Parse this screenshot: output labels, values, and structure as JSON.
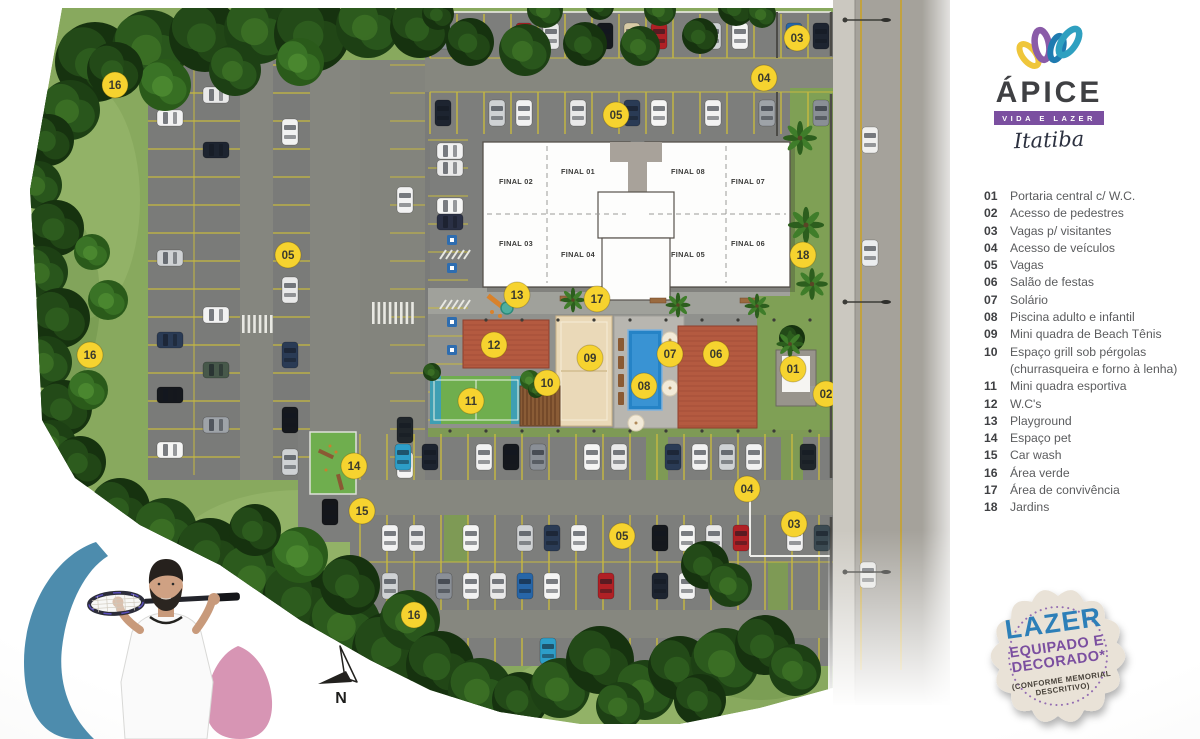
{
  "logo": {
    "name": "ÁPICE",
    "tagline": "VIDA E LAZER",
    "city": "Itatiba"
  },
  "legend": {
    "items": [
      {
        "num": "01",
        "label": "Portaria central c/ W.C."
      },
      {
        "num": "02",
        "label": "Acesso de pedestres"
      },
      {
        "num": "03",
        "label": "Vagas p/ visitantes"
      },
      {
        "num": "04",
        "label": "Acesso de veículos"
      },
      {
        "num": "05",
        "label": "Vagas"
      },
      {
        "num": "06",
        "label": "Salão de festas"
      },
      {
        "num": "07",
        "label": "Solário"
      },
      {
        "num": "08",
        "label": "Piscina adulto e infantil"
      },
      {
        "num": "09",
        "label": "Mini quadra de Beach Tênis"
      },
      {
        "num": "10",
        "label": "Espaço grill sob pérgolas",
        "label2": "(churrasqueira e forno à lenha)"
      },
      {
        "num": "11",
        "label": "Mini quadra esportiva"
      },
      {
        "num": "12",
        "label": "W.C's"
      },
      {
        "num": "13",
        "label": "Playground"
      },
      {
        "num": "14",
        "label": "Espaço pet"
      },
      {
        "num": "15",
        "label": "Car wash"
      },
      {
        "num": "16",
        "label": "Área verde"
      },
      {
        "num": "17",
        "label": "Área de convivência"
      },
      {
        "num": "18",
        "label": "Jardins"
      }
    ]
  },
  "badge": {
    "line1": "LAZER",
    "line2": "EQUIPADO E",
    "line3": "DECORADO*",
    "note1": "(CONFORME MEMORIAL",
    "note2": "DESCRITIVO)"
  },
  "map": {
    "compass": "N",
    "units": [
      {
        "label": "FINAL 02",
        "x": 516,
        "y": 184
      },
      {
        "label": "FINAL 01",
        "x": 578,
        "y": 174
      },
      {
        "label": "FINAL 08",
        "x": 688,
        "y": 174
      },
      {
        "label": "FINAL 07",
        "x": 748,
        "y": 184
      },
      {
        "label": "FINAL 03",
        "x": 516,
        "y": 246
      },
      {
        "label": "FINAL 04",
        "x": 578,
        "y": 257
      },
      {
        "label": "FINAL 05",
        "x": 688,
        "y": 257
      },
      {
        "label": "FINAL 06",
        "x": 748,
        "y": 246
      }
    ],
    "markers": [
      {
        "n": "16",
        "x": 115,
        "y": 85
      },
      {
        "n": "03",
        "x": 797,
        "y": 38
      },
      {
        "n": "04",
        "x": 764,
        "y": 78
      },
      {
        "n": "05",
        "x": 616,
        "y": 115
      },
      {
        "n": "05",
        "x": 288,
        "y": 255
      },
      {
        "n": "16",
        "x": 90,
        "y": 355
      },
      {
        "n": "18",
        "x": 803,
        "y": 255
      },
      {
        "n": "13",
        "x": 517,
        "y": 295
      },
      {
        "n": "17",
        "x": 597,
        "y": 299
      },
      {
        "n": "12",
        "x": 494,
        "y": 345
      },
      {
        "n": "09",
        "x": 590,
        "y": 358
      },
      {
        "n": "07",
        "x": 670,
        "y": 354
      },
      {
        "n": "06",
        "x": 716,
        "y": 354
      },
      {
        "n": "01",
        "x": 793,
        "y": 369
      },
      {
        "n": "02",
        "x": 826,
        "y": 394
      },
      {
        "n": "10",
        "x": 547,
        "y": 383
      },
      {
        "n": "08",
        "x": 644,
        "y": 386
      },
      {
        "n": "11",
        "x": 471,
        "y": 401
      },
      {
        "n": "14",
        "x": 354,
        "y": 466
      },
      {
        "n": "15",
        "x": 362,
        "y": 511
      },
      {
        "n": "05",
        "x": 622,
        "y": 536
      },
      {
        "n": "04",
        "x": 747,
        "y": 489
      },
      {
        "n": "03",
        "x": 794,
        "y": 524
      },
      {
        "n": "16",
        "x": 414,
        "y": 615
      }
    ]
  },
  "colors": {
    "marker": "#f6d32f",
    "accent_purple": "#7b4fa0",
    "accent_blue": "#2d7fb8",
    "accent_teal": "#2fa0c0",
    "accent_yellow": "#efc63b",
    "accent_pink": "#d795b4"
  }
}
